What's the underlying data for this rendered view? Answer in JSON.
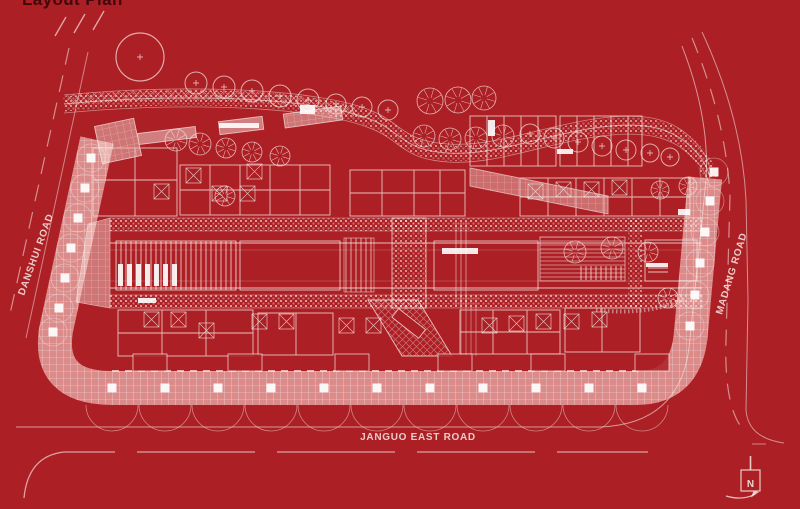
{
  "title": "Layout Plan",
  "colors": {
    "background": "#AC1F24",
    "drawing": "#F7E9E5",
    "title": "#42080B",
    "walk": "#E9C6C0"
  },
  "plan": {
    "roads": [
      {
        "id": "danshui",
        "label": "DANSHUI ROAD",
        "position": "left"
      },
      {
        "id": "madang",
        "label": "MADANG ROAD",
        "position": "right"
      },
      {
        "id": "janguo-east",
        "label": "JANGUO EAST ROAD",
        "position": "bottom"
      }
    ],
    "compass": {
      "label": "N",
      "position": "bottom-right"
    }
  }
}
